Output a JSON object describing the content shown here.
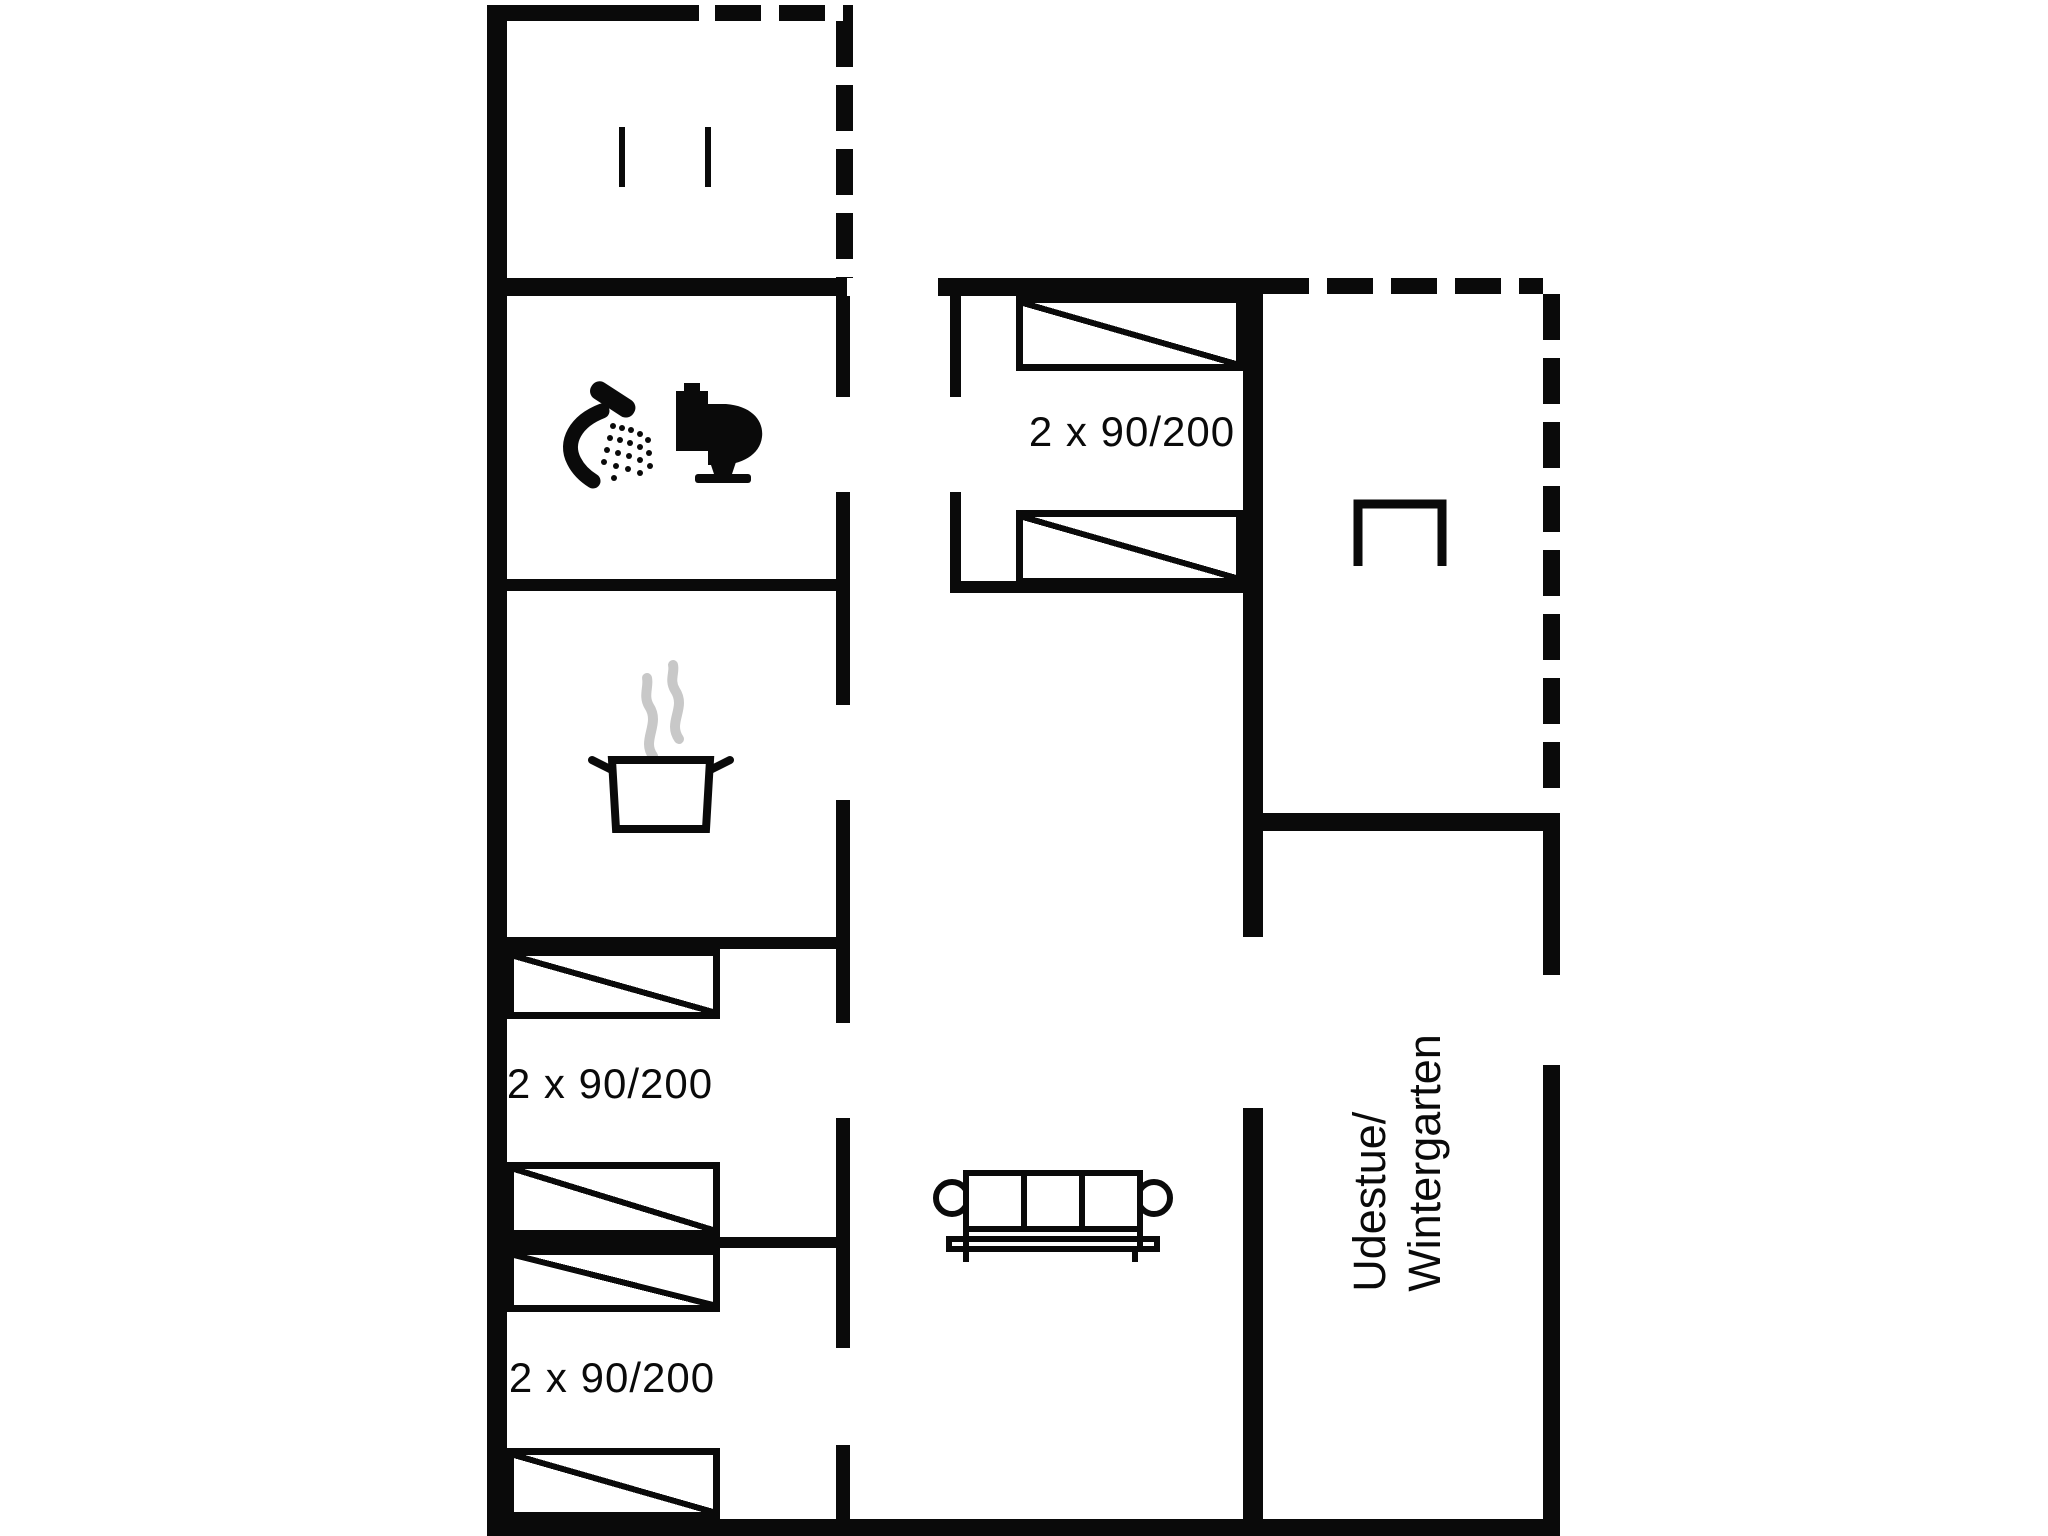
{
  "title": "holiday-house-floor-plan",
  "colors": {
    "background": "#ffffff",
    "line": "#0a0a0a",
    "steam": "#c8c8c8"
  },
  "rooms": {
    "entry_porch": {
      "icons": [
        "door-marker"
      ]
    },
    "bathroom": {
      "icons": [
        "shower-icon",
        "toilet-icon"
      ]
    },
    "kitchen": {
      "icons": [
        "cooking-pot-icon",
        "steam-icon"
      ]
    },
    "bedroom_left_front": {
      "bed_label": "2 x 90/200",
      "beds": 2
    },
    "bedroom_left_back": {
      "bed_label": "2 x 90/200",
      "beds": 2
    },
    "bedroom_middle": {
      "bed_label": "2 x 90/200",
      "beds": 2
    },
    "living_room": {
      "icons": [
        "sofa-icon"
      ]
    },
    "terrace": {
      "icons": [
        "table-icon"
      ]
    },
    "conservatory": {
      "label_line1": "Udestue/",
      "label_line2": "Wintergarten"
    }
  }
}
